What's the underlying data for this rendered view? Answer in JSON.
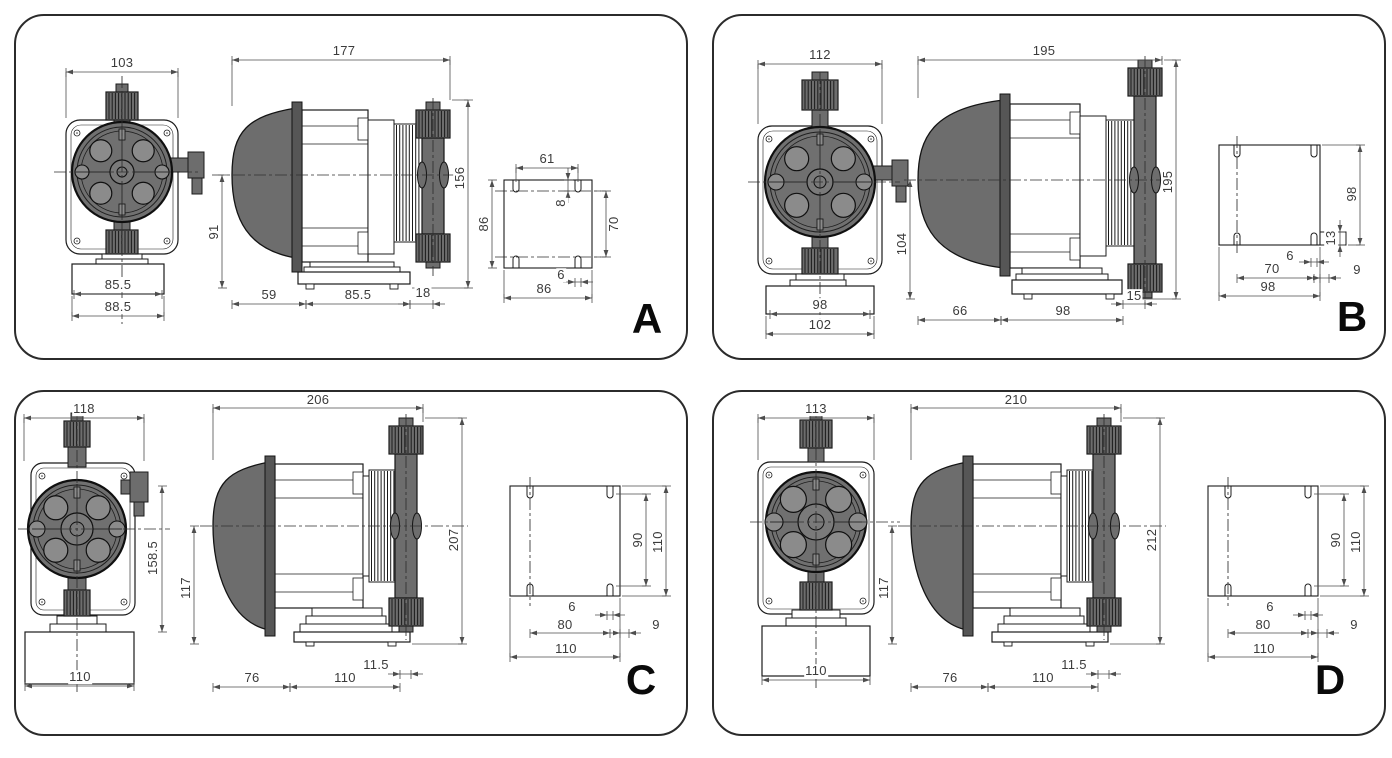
{
  "style": {
    "line_color": "#1c1c1c",
    "dim_line_color": "#4d4d4d",
    "fill_dark": "#6d6d6d",
    "fill_darker": "#565656",
    "fill_mid": "#8b8b8b",
    "background": "#ffffff",
    "text_color": "#3b3b3b"
  },
  "panels": [
    {
      "label": "A",
      "front": {
        "top_width": "103",
        "base_width_inner": "85.5",
        "base_width_outer": "88.5"
      },
      "side": {
        "top_width": "177",
        "height_right": "156",
        "height_left": "91",
        "bottom_segments": [
          "59",
          "85.5",
          "18"
        ]
      },
      "bracket": {
        "top_width": "61",
        "slot_offset": "8",
        "height_left": "86",
        "hole_spacing_right": "70",
        "slot_width": "6",
        "bottom_width": "86"
      }
    },
    {
      "label": "B",
      "front": {
        "top_width": "112",
        "base_width_inner": "98",
        "base_width_outer": "102"
      },
      "side": {
        "top_width": "195",
        "height_right": "195",
        "height_left": "104",
        "bottom_segments": [
          "66",
          "98",
          "15"
        ]
      },
      "bracket": {
        "height_right": "98",
        "step_height": "13",
        "slot_width": "6",
        "hole_spacing_bottom": "70",
        "side_offset": "9",
        "bottom_width": "98"
      }
    },
    {
      "label": "C",
      "front": {
        "top_width": "118",
        "height_right": "158.5",
        "base_width": "110"
      },
      "side": {
        "top_width": "206",
        "height_right": "207",
        "height_left": "117",
        "bottom_segments": [
          "76",
          "110",
          "11.5"
        ]
      },
      "bracket": {
        "hole_spacing_right": "90",
        "height_right": "110",
        "slot_width": "6",
        "hole_spacing_bottom": "80",
        "side_offset": "9",
        "bottom_width": "110"
      }
    },
    {
      "label": "D",
      "front": {
        "top_width": "113",
        "base_width": "110"
      },
      "side": {
        "top_width": "210",
        "height_right": "212",
        "height_left": "117",
        "bottom_segments": [
          "76",
          "110",
          "11.5"
        ]
      },
      "bracket": {
        "hole_spacing_right": "90",
        "height_right": "110",
        "slot_width": "6",
        "hole_spacing_bottom": "80",
        "side_offset": "9",
        "bottom_width": "110"
      }
    }
  ]
}
